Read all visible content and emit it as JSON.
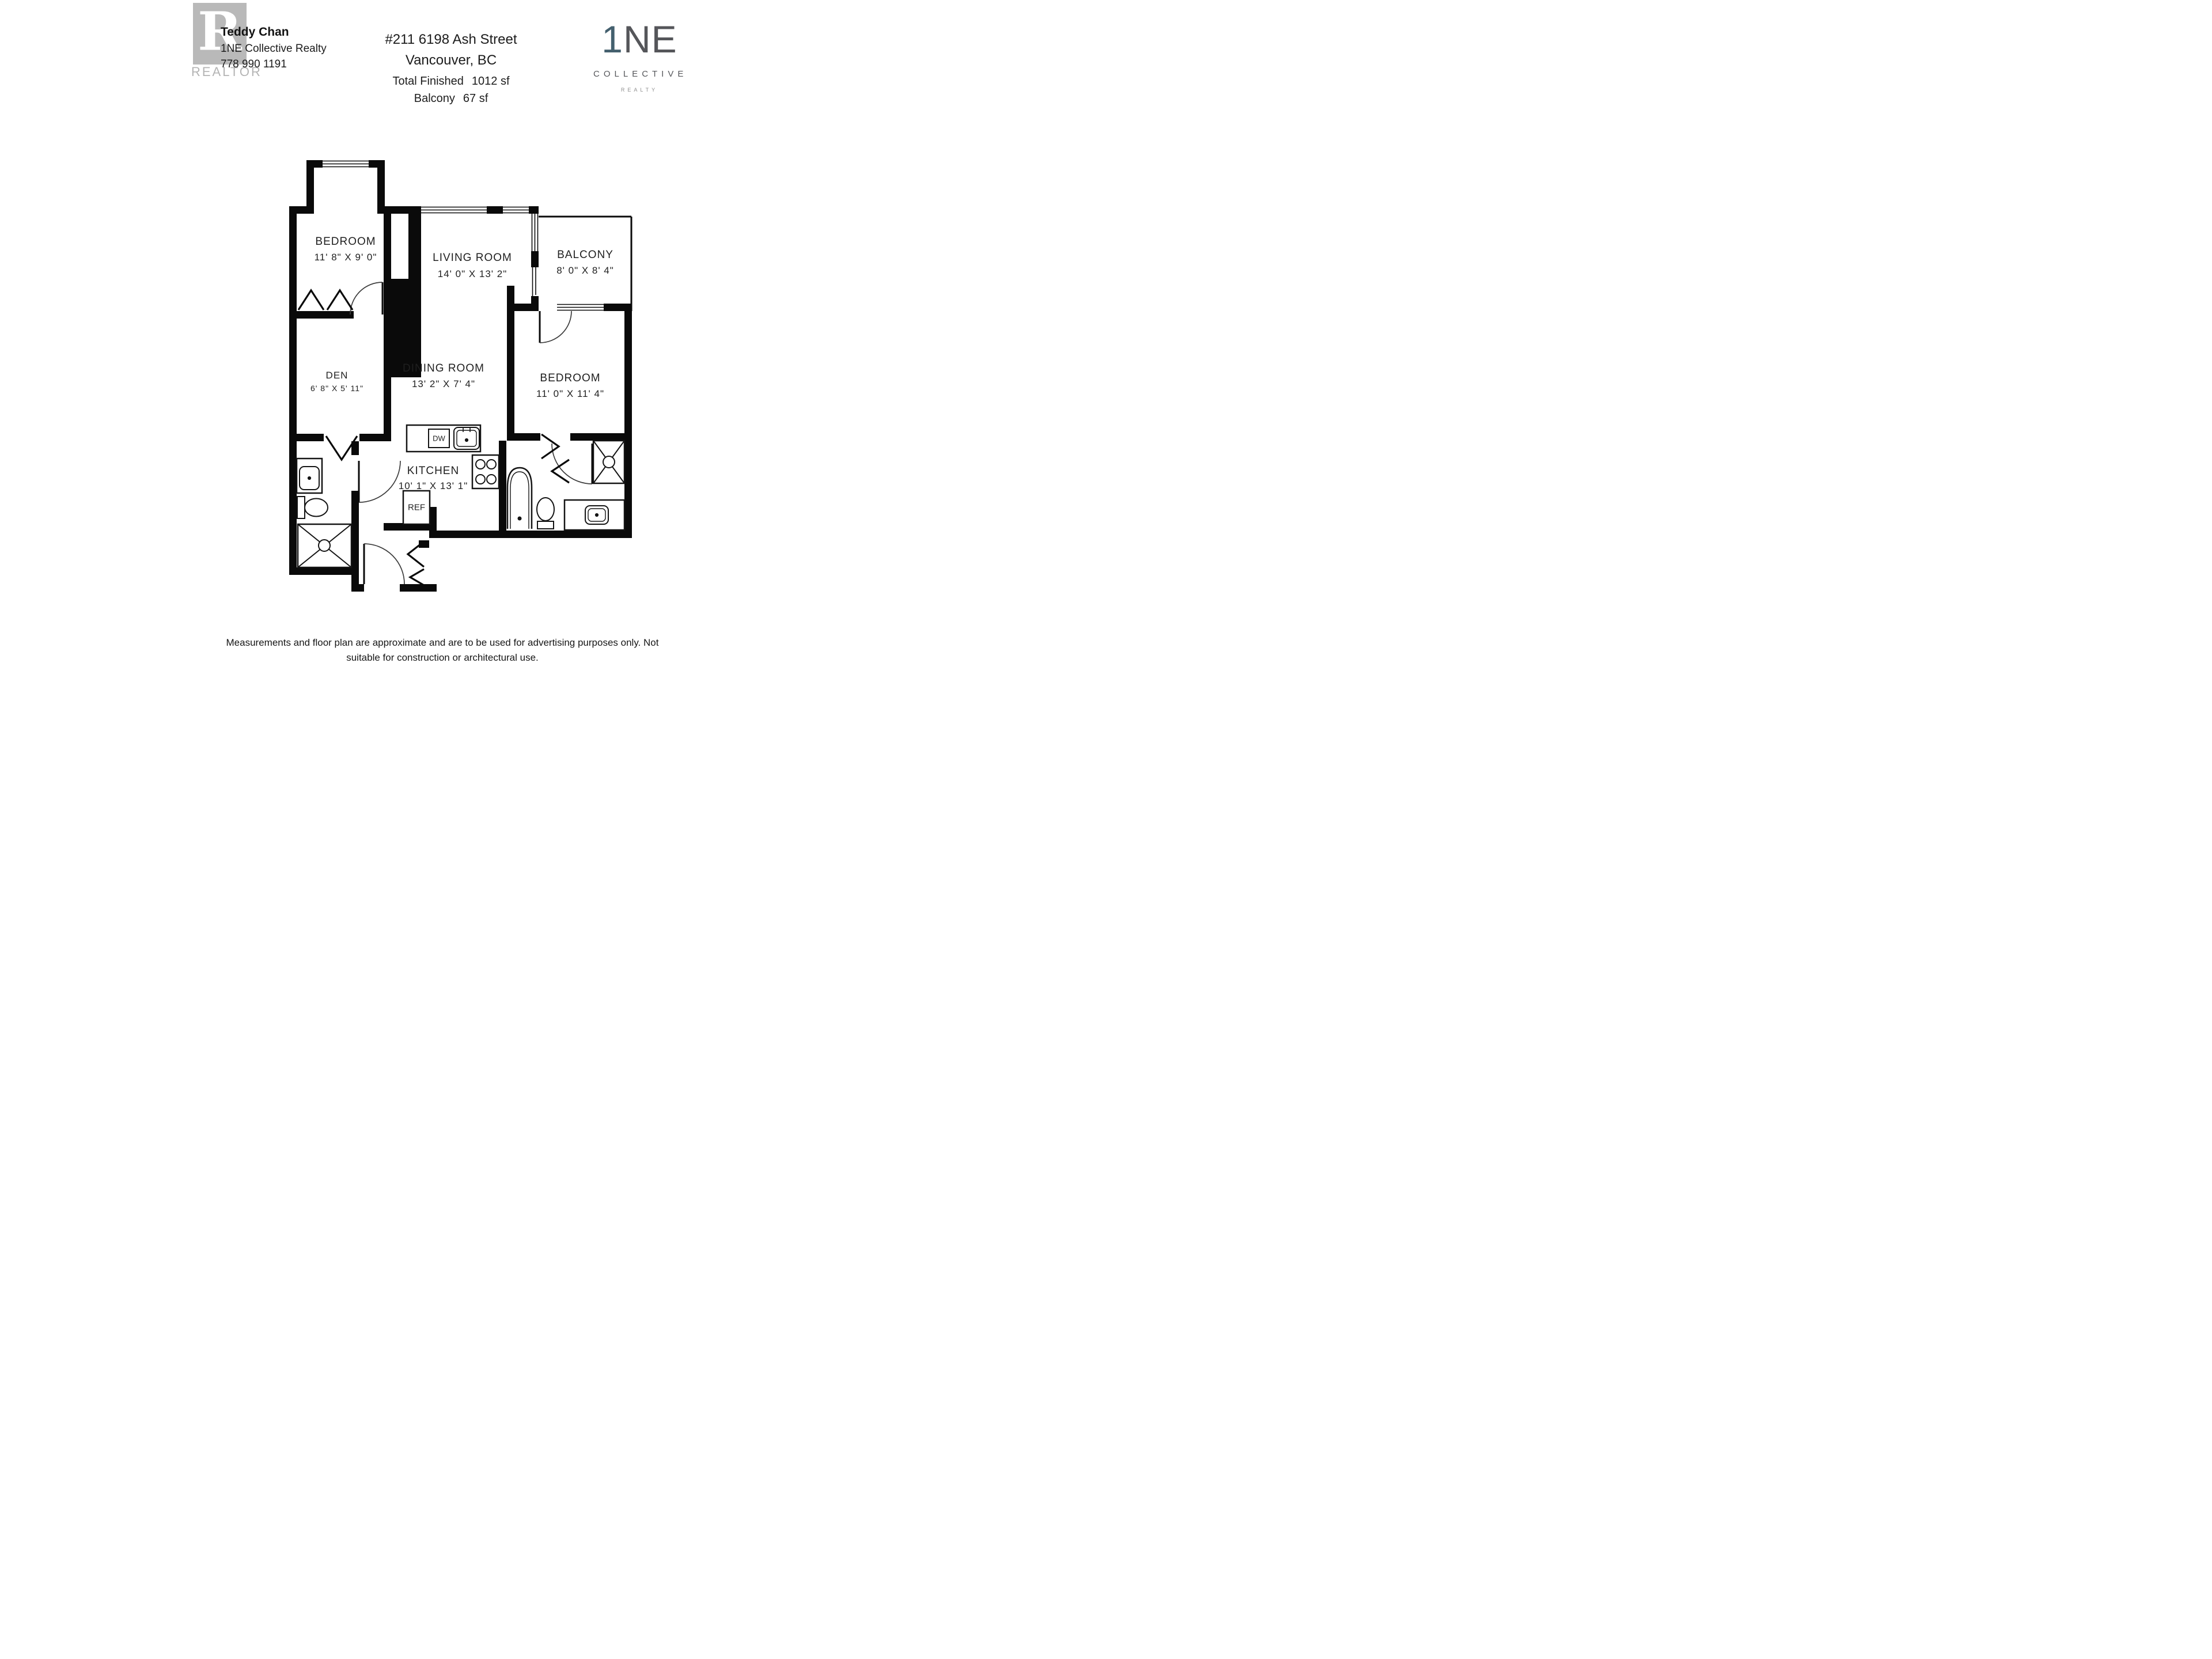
{
  "header": {
    "agent": {
      "name": "Teddy Chan",
      "brokerage": "1NE Collective Realty",
      "phone": "778 990 1191",
      "realtor_letter": "R",
      "realtor_word": "REALTOR"
    },
    "listing": {
      "address_line1": "#211 6198 Ash Street",
      "address_line2": "Vancouver, BC",
      "total_finished_label": "Total Finished",
      "total_finished_value": "1012 sf",
      "balcony_label": "Balcony",
      "balcony_value": "67 sf"
    },
    "brokerage_logo": {
      "mark_one": "1",
      "mark_ne": "NE",
      "line2": "COLLECTIVE",
      "line3": "REALTY"
    }
  },
  "plan": {
    "rooms": [
      {
        "name": "BEDROOM",
        "dims": "11' 8\" X 9' 0\""
      },
      {
        "name": "LIVING ROOM",
        "dims": "14' 0\" X 13' 2\""
      },
      {
        "name": "BALCONY",
        "dims": "8' 0\" X 8' 4\""
      },
      {
        "name": "DEN",
        "dims": "6' 8\" X 5' 11\""
      },
      {
        "name": "DINING ROOM",
        "dims": "13' 2\" X 7' 4\""
      },
      {
        "name": "BEDROOM",
        "dims": "11' 0\" X 11' 4\""
      },
      {
        "name": "KITCHEN",
        "dims": "10' 1\" X 13' 1\""
      }
    ],
    "appliances": {
      "dishwasher": "DW",
      "refrigerator": "REF"
    }
  },
  "footer": {
    "line1": "Measurements and floor plan are approximate and are to be used for advertising purposes only. Not suitable for construction or architectural use.",
    "line2": "Square footage calculated using ANSI Z765 method. AUGUST 2025."
  },
  "colors": {
    "wall_black": "#0a0a0a",
    "accent_blue": "#44606e",
    "logo_gray": "#55565a",
    "realtor_gray": "#a8a8a8"
  }
}
